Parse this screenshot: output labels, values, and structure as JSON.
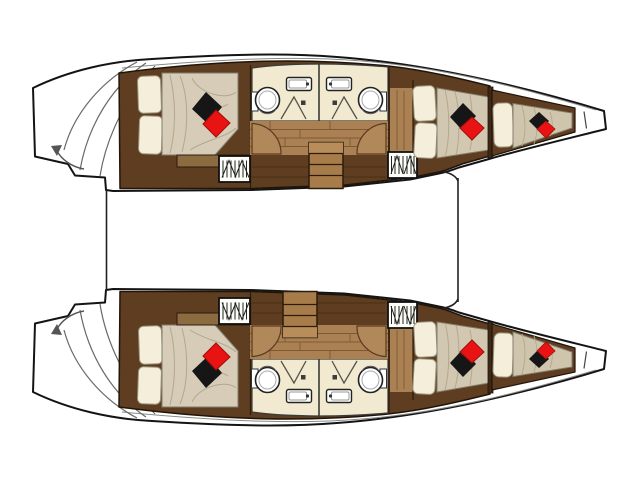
{
  "floor_plan": {
    "vessel_type": "catamaran",
    "view": "top-down-deck-plan",
    "bow_direction": "right",
    "hulls": [
      {
        "name": "hull-top",
        "compartments_fore_to_aft": [
          "bow-berth",
          "forward-double-cabin",
          "bathroom-forward",
          "bathroom-aft",
          "companionway-staircase",
          "corridor",
          "aft-double-cabin",
          "transom-steps"
        ]
      },
      {
        "name": "hull-bottom",
        "compartments_fore_to_aft": [
          "bow-berth",
          "forward-double-cabin",
          "bathroom-forward",
          "bathroom-aft",
          "companionway-staircase",
          "corridor",
          "aft-double-cabin",
          "transom-steps"
        ]
      }
    ],
    "element_counts": {
      "double_beds": 4,
      "bow_berths": 2,
      "toilets": 4,
      "sinks": 4,
      "shower_doors": 4,
      "staircases": 2,
      "hatch_grates": 4,
      "door_swings": 4,
      "black_decor_pillows": 6,
      "red_decor_pillows": 6,
      "transom_step_arrows": 2
    }
  },
  "colors": {
    "background": "#ffffff",
    "hull_outline": "#141414",
    "dark_wood": "#5e3d20",
    "plank_wood": "#ab8154",
    "stair_wood": "#a87c4a",
    "bench_wood": "#8d6b41",
    "bed_linen": "#d6ccb8",
    "bed_linen_fwd": "#d2c8b2",
    "bed_linen_bow": "#cfc5ad",
    "pillow_cream": "#f4eeda",
    "bathroom_floor": "#f2ead0",
    "fixture_white": "#ffffff",
    "pillow_black": "#161616",
    "pillow_red": "#e91313",
    "door_wood": "#b1885a"
  }
}
